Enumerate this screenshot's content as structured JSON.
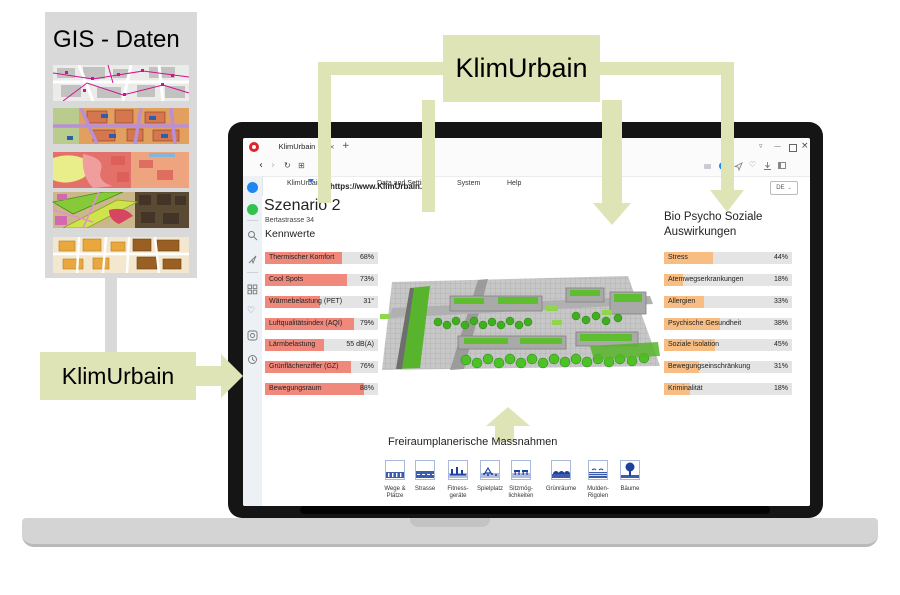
{
  "colors": {
    "accent_green": "#dee4b6",
    "salmon_bar": "#f0897b",
    "orange_bar": "#f7bd82",
    "bar_track": "#e4e4e4",
    "opera_red": "#e0242a",
    "messenger_blue": "#1e88f0",
    "whatsapp_green": "#32c24d",
    "pictogram_navy": "#1d3f9e"
  },
  "diagram": {
    "gis_box": {
      "title": "GIS - Daten",
      "maps": [
        "cadastral-street-map",
        "zoning-map",
        "heat-map",
        "greenspace-map",
        "landuse-map"
      ]
    },
    "left_label": "KlimUrbain",
    "top_label": "KlimUrbain"
  },
  "browser": {
    "tab_title": "KlimUrbain",
    "tab_close": "×",
    "new_tab": "+",
    "url": "https://www.KlimUrbain.ch",
    "window_controls": {
      "menu": "▿",
      "minimize": "—",
      "close": "×"
    },
    "nav": {
      "back": "‹",
      "forward": "›",
      "reload": "↻",
      "speeddial": "⊞"
    },
    "menu": {
      "items": [
        "KlimUrbain",
        "Data and Settings",
        "System",
        "Help"
      ]
    },
    "lang": "DE",
    "sidebar_more": "⋯",
    "heart": "♡"
  },
  "page": {
    "scenario": {
      "title": "Szenario 2",
      "subtitle": "Bertastrasse 34"
    },
    "kennwerte": {
      "title": "Kennwerte",
      "items": [
        {
          "label": "Thermischer Komfort",
          "value": "68%",
          "fill": 68
        },
        {
          "label": "Cool Spots",
          "value": "73%",
          "fill": 73
        },
        {
          "label": "Wärmebelastung (PET)",
          "value": "31°",
          "fill": 49
        },
        {
          "label": "Luftqualitätsindex (AQI)",
          "value": "79%",
          "fill": 79
        },
        {
          "label": "Lärmbelastung",
          "value": "55 dB(A)",
          "fill": 52
        },
        {
          "label": "Grünflächenziffer (GZ)",
          "value": "76%",
          "fill": 76
        },
        {
          "label": "Bewegungsraum",
          "value": "88%",
          "fill": 88
        }
      ]
    },
    "auswirkungen": {
      "title_line1": "Bio Psycho Soziale",
      "title_line2": "Auswirkungen",
      "items": [
        {
          "label": "Stress",
          "value": "44%",
          "fill": 38
        },
        {
          "label": "Atemwegserkrankungen",
          "value": "18%",
          "fill": 15
        },
        {
          "label": "Allergien",
          "value": "33%",
          "fill": 31
        },
        {
          "label": "Psychische Gesundheit",
          "value": "38%",
          "fill": 44
        },
        {
          "label": "Soziale Isolation",
          "value": "45%",
          "fill": 40
        },
        {
          "label": "Bewegungseinschränkung",
          "value": "31%",
          "fill": 27
        },
        {
          "label": "Kriminalität",
          "value": "18%",
          "fill": 20
        }
      ]
    },
    "massnahmen": {
      "title": "Freiraumplanerische Massnahmen",
      "items": [
        {
          "label": "Wege &\nPlätze"
        },
        {
          "label": "Strasse"
        },
        {
          "label": "Fitness-\ngeräte"
        },
        {
          "label": "Spielplatz"
        },
        {
          "label": "Sitzmög-\nlichkeiten"
        },
        {
          "label": "Grünräume"
        },
        {
          "label": "Mulden-\nRigolen"
        },
        {
          "label": "Bäume"
        }
      ]
    }
  }
}
